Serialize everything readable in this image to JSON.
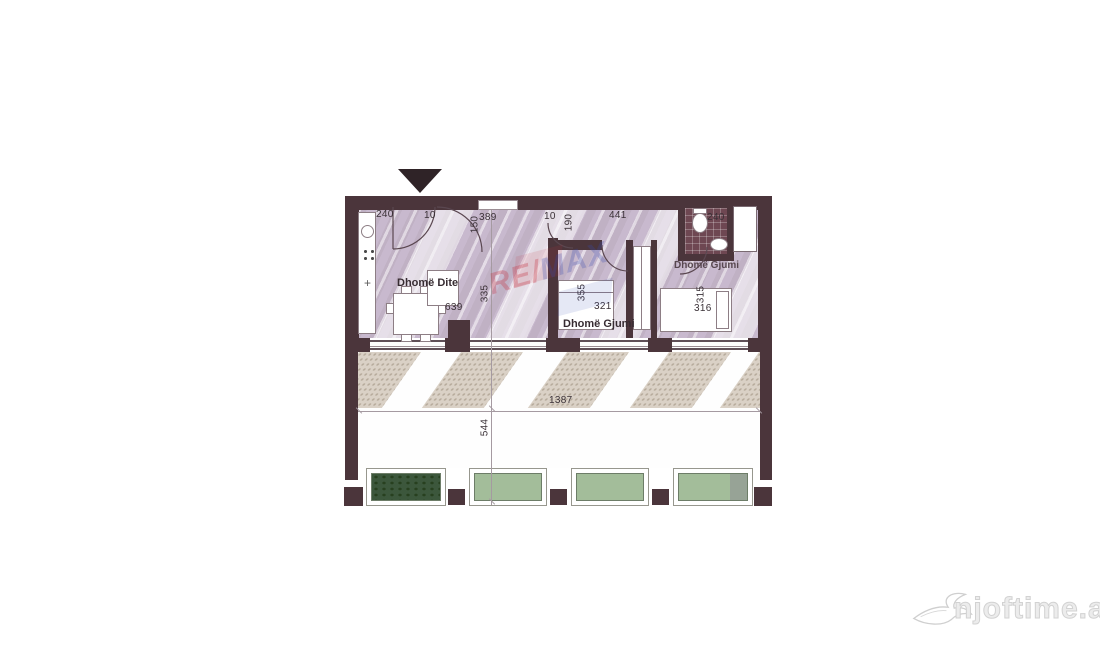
{
  "floorplan": {
    "rooms": [
      {
        "id": "living-room",
        "label": "Dhomë Dite"
      },
      {
        "id": "bedroom-1",
        "label": "Dhomë Gjumi"
      },
      {
        "id": "bedroom-2",
        "label": "Dhomë Gjumi"
      }
    ],
    "dimensions": {
      "entry_width": "240",
      "entry_clear": "10",
      "hall_width": "389",
      "hall_depth": "150",
      "mid_clear": "10",
      "mid_depth": "190",
      "corridor_length": "441",
      "bathroom_width": "240",
      "living_width": "639",
      "living_depth": "335",
      "bedroom1_depth": "355",
      "bedroom1_width": "321",
      "bedroom2_depth": "315",
      "bedroom2_width": "316",
      "terrace_width": "1387",
      "terrace_depth": "544"
    },
    "icons": {
      "entrance_marker": "triangle-down-icon",
      "logo_bird": "swallow-icon"
    },
    "colors": {
      "wall": "#4b353b",
      "floor_hatch": "#cec1d3",
      "bathroom_tile": "#6e4752",
      "terrace_shadow": "#d7cec2",
      "planter_light_green": "#a3bd9a",
      "planter_dark_green": "#3c573c",
      "remax_red": "#c5303a",
      "remax_blue": "#364ab2",
      "logo_gray": "#d8d8d8"
    }
  },
  "watermarks": {
    "remax": {
      "part1": "RE/",
      "part2": "MAX"
    },
    "njoftime": {
      "label": "njoftime.al"
    }
  }
}
